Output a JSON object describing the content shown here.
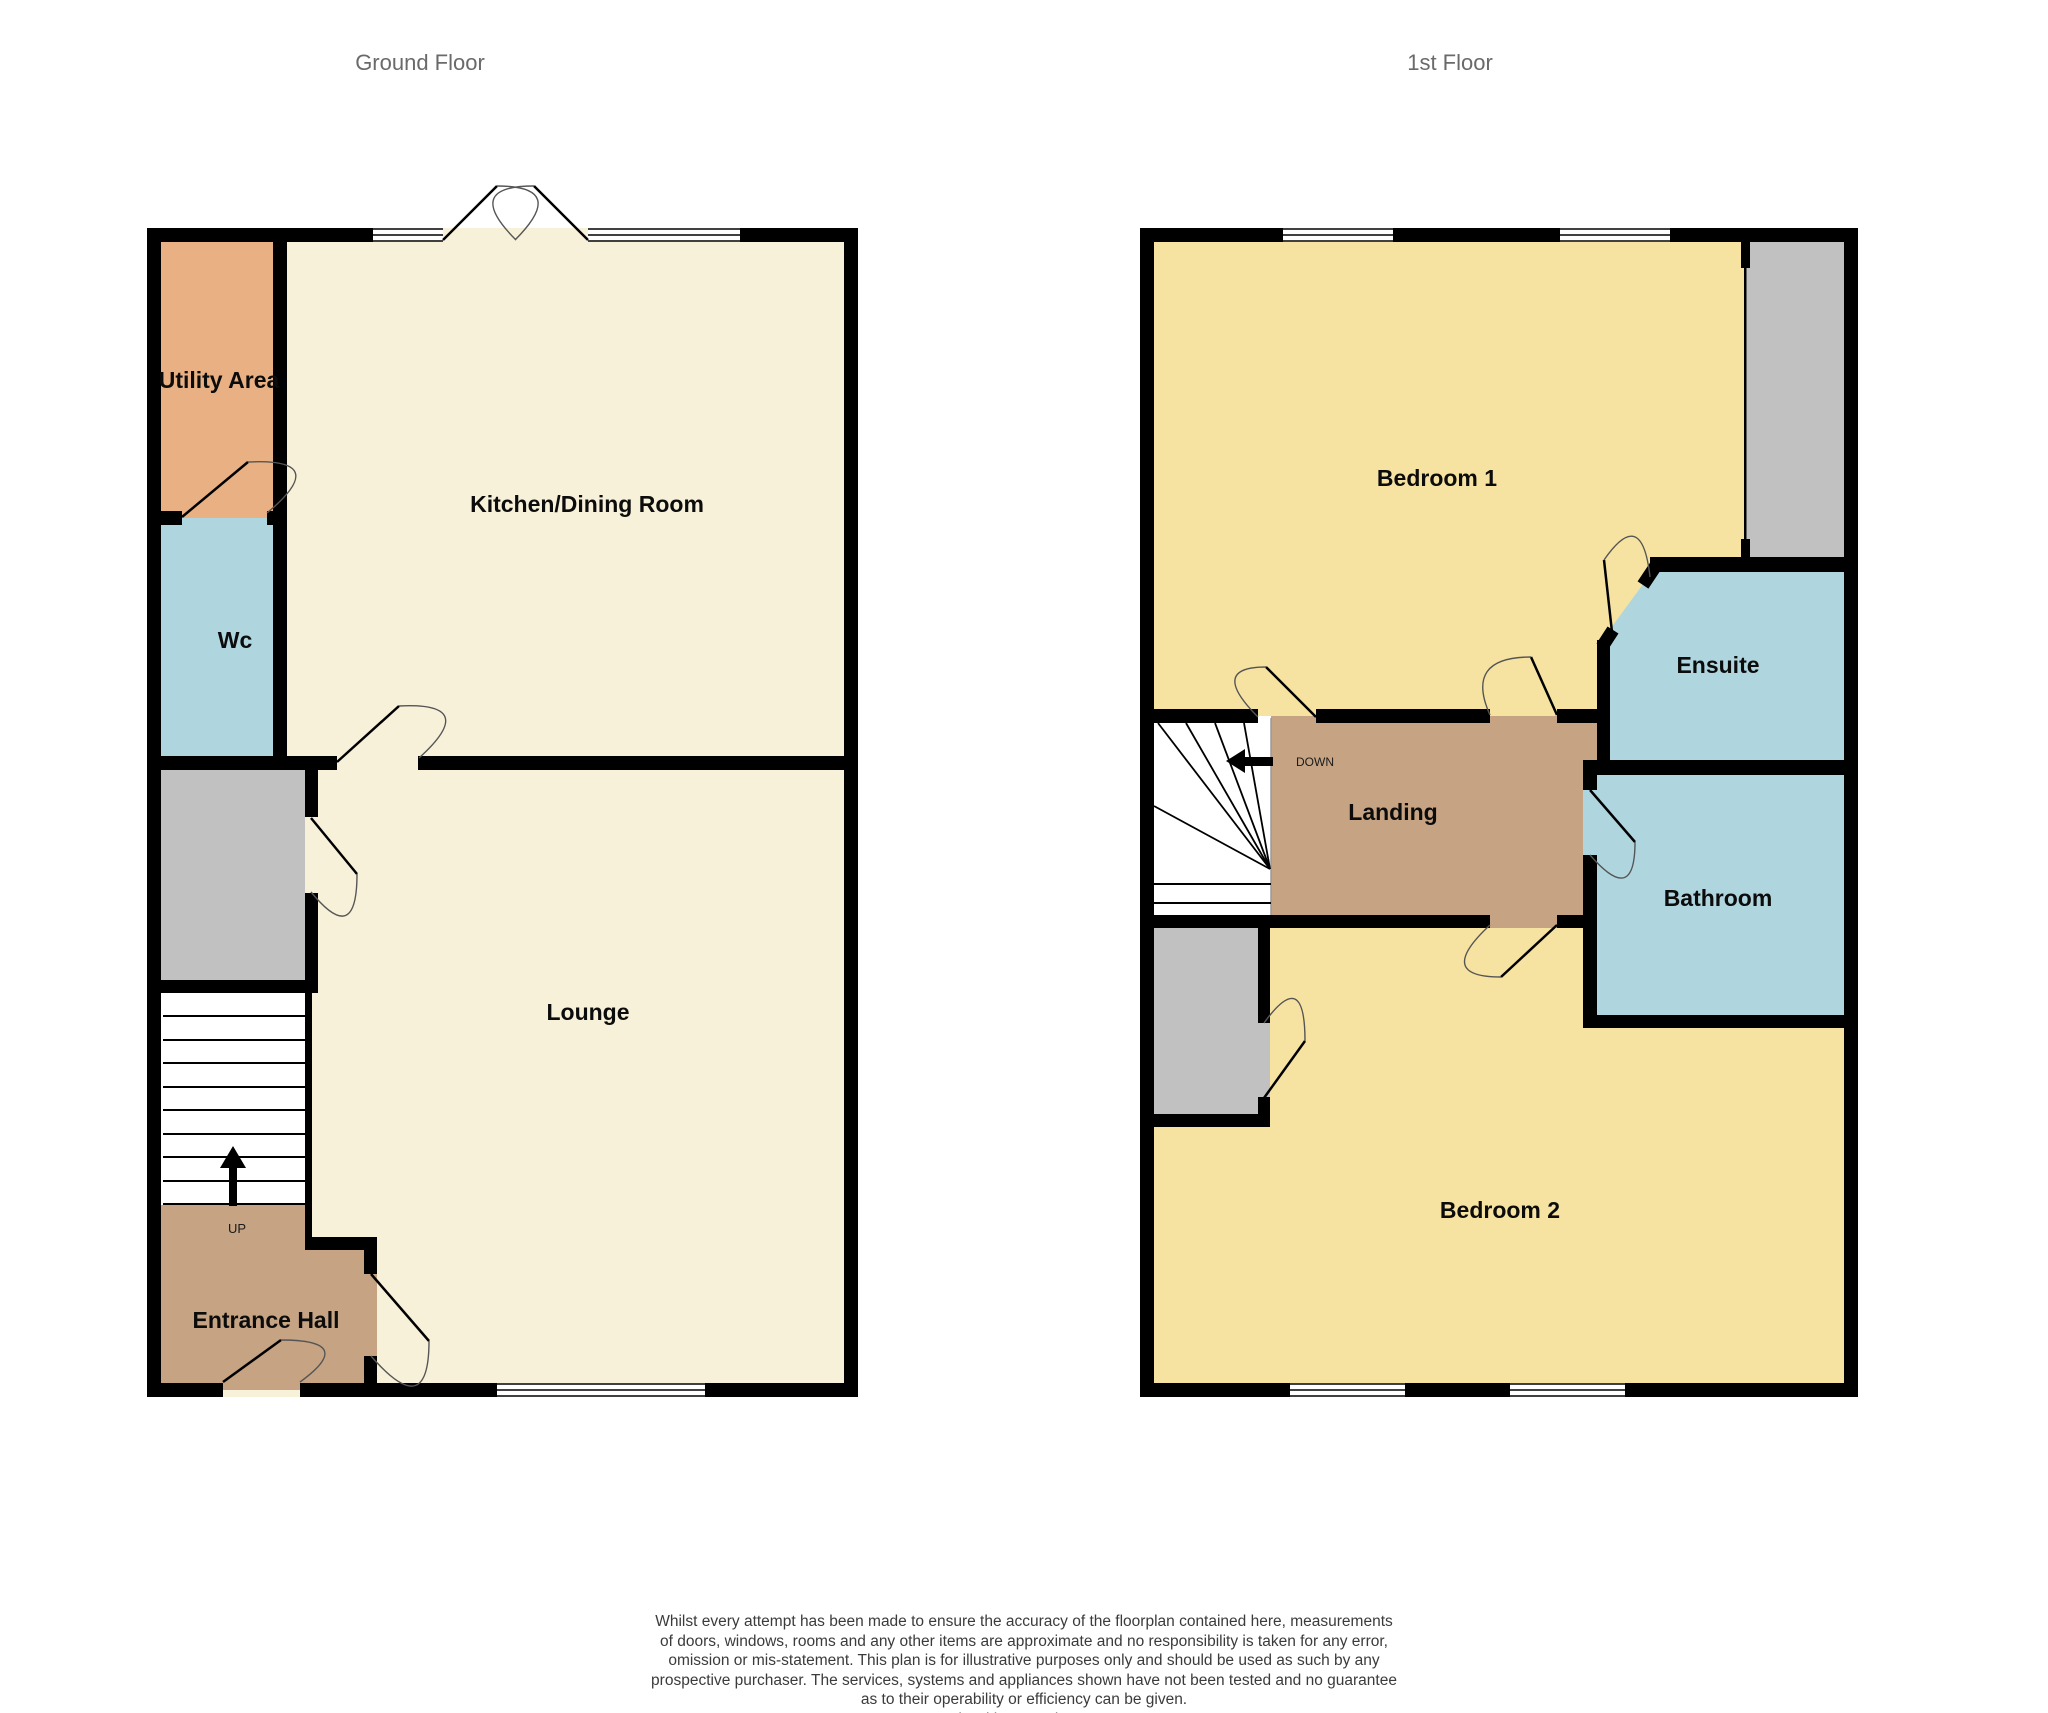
{
  "titles": {
    "ground": "Ground Floor",
    "first": "1st Floor"
  },
  "ground_floor": {
    "rooms": {
      "utility": "Utility Area",
      "wc": "Wc",
      "kitchen": "Kitchen/Dining Room",
      "lounge": "Lounge",
      "entrance": "Entrance Hall"
    },
    "stair_label": "UP"
  },
  "first_floor": {
    "rooms": {
      "bedroom1": "Bedroom 1",
      "ensuite": "Ensuite",
      "landing": "Landing",
      "bathroom": "Bathroom",
      "bedroom2": "Bedroom 2"
    },
    "stair_label": "DOWN"
  },
  "colors": {
    "cream": "#F8F1DA",
    "yellow": "#F6E3A1",
    "orange": "#E9B183",
    "blue": "#AFD6DF",
    "tan": "#C5A383",
    "gray": "#C1C1C1",
    "wall": "#000000"
  },
  "disclaimer": {
    "lines": [
      "Whilst every attempt has been made to ensure the accuracy of the floorplan contained here, measurements",
      "of doors, windows, rooms and any other items are approximate and no responsibility is taken for any error,",
      "omission or mis-statement. This plan is for illustrative purposes only and should be used as such by any",
      "prospective purchaser. The services, systems and appliances shown have not been tested and no guarantee",
      "as to their operability or efficiency can be given.",
      "Made with Metropix ©2026"
    ]
  }
}
